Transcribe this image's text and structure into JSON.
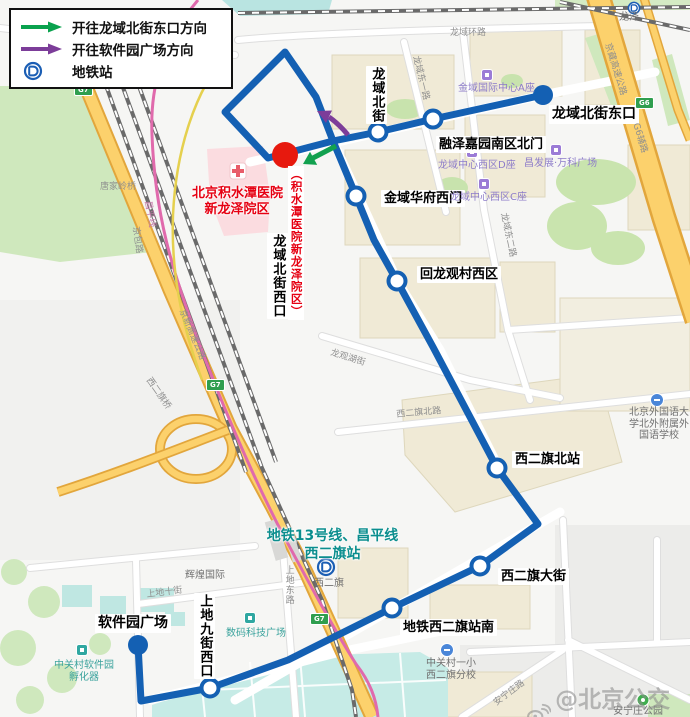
{
  "legend": {
    "items": [
      {
        "label": "开往龙域北街东口方向",
        "arrow_color": "#0aa24e"
      },
      {
        "label": "开往软件园广场方向",
        "arrow_color": "#7c3d99"
      },
      {
        "label": "地铁站"
      }
    ]
  },
  "route": {
    "line_color": "#1460b3",
    "hospital_stop_color": "#e7190e",
    "stops": [
      {
        "name": "龙域北街东口",
        "type": "terminal"
      },
      {
        "name": "融泽嘉园南区北门",
        "type": "stop"
      },
      {
        "name": "龙域北街",
        "type": "stop"
      },
      {
        "name": "龙域北街西口",
        "type": "hospital-stop"
      },
      {
        "name": "金域华府西门",
        "type": "stop"
      },
      {
        "name": "回龙观村西区",
        "type": "stop"
      },
      {
        "name": "西二旗北站",
        "type": "stop"
      },
      {
        "name": "西二旗大街",
        "type": "stop"
      },
      {
        "name": "地铁西二旗站南",
        "type": "stop"
      },
      {
        "name": "上地九街西口",
        "type": "stop"
      },
      {
        "name": "软件园广场",
        "type": "terminal"
      }
    ],
    "hospital_note": "（积水潭医院新龙泽院区）"
  },
  "hospital": {
    "name_line1": "北京积水潭医院",
    "name_line2": "新龙泽院区"
  },
  "metro_station_note": {
    "line1": "地铁13号线、昌平线",
    "line2": "西二旗站"
  },
  "map": {
    "pois": [
      {
        "name": "金域国际中心A座",
        "kind": "purple"
      },
      {
        "name": "龙域中心西区D座",
        "kind": "purple"
      },
      {
        "name": "龙域中心西区C座",
        "kind": "purple"
      },
      {
        "name": "昌发展·万科广场",
        "kind": "purple"
      },
      {
        "name": "辉煌国际",
        "kind": "gray"
      },
      {
        "name": "数码科技广场",
        "kind": "teal"
      },
      {
        "name": "中关村软件园孵化器",
        "kind": "teal"
      },
      {
        "name": "北京外国语大学北外附属外国语学校",
        "kind": "gray"
      },
      {
        "name": "中关村一小西二旗分校",
        "kind": "gray"
      },
      {
        "name": "安宁庄公园",
        "kind": "gray"
      },
      {
        "name": "龙泽",
        "kind": "metro"
      },
      {
        "name": "西二旗",
        "kind": "metro"
      }
    ],
    "road_labels": [
      "龙域环路",
      "龙域东一路",
      "龙域东二路",
      "京藏高速公路",
      "G6辅路",
      "京新高速公路",
      "西二旗桥",
      "唐家岭桥",
      "京包路",
      "昌平线",
      "西二旗北路",
      "上地东路",
      "上地十街",
      "龙观湖街",
      "安宁庄路"
    ],
    "shields": [
      "G7",
      "G7",
      "G7",
      "G6"
    ],
    "watermark": "@北京公交集团"
  }
}
